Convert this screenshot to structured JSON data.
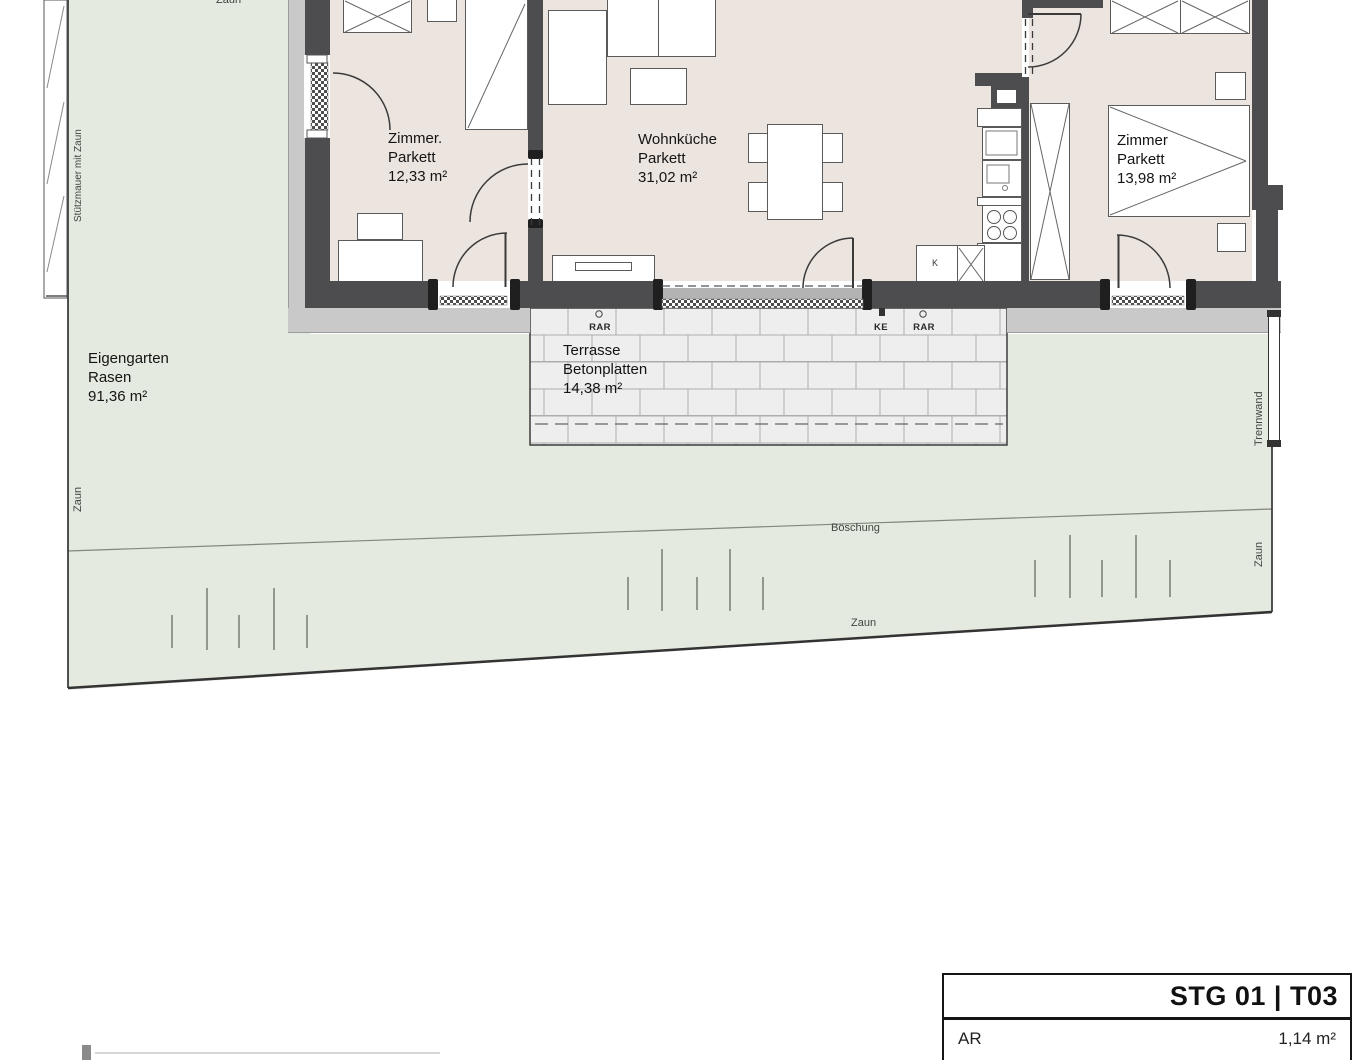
{
  "plan": {
    "rooms": {
      "zimmer_left": {
        "name": "Zimmer.",
        "floor": "Parkett",
        "area": "12,33 m²"
      },
      "wohnkueche": {
        "name": "Wohnküche",
        "floor": "Parkett",
        "area": "31,02 m²"
      },
      "zimmer_right": {
        "name": "Zimmer",
        "floor": "Parkett",
        "area": "13,98 m²"
      }
    },
    "outdoor": {
      "garden": {
        "name": "Eigengarten",
        "surface": "Rasen",
        "area": "91,36 m²"
      },
      "terrace": {
        "name": "Terrasse",
        "surface": "Betonplatten",
        "area": "14,38 m²"
      },
      "slope": "Böschung",
      "fence_top": "Zaun",
      "fence_left": "Zaun",
      "fence_bottom": "Zaun",
      "fence_right": "Zaun",
      "retaining_wall": "Stützmauer mit Zaun",
      "partition": "Trennwand"
    },
    "markers": {
      "rar_left": "RAR",
      "ke": "KE",
      "rar_right": "RAR",
      "kitchen_k": "K"
    }
  },
  "title_block": {
    "title": "STG 01 | T03",
    "rows": [
      {
        "label": "AR",
        "value": "1,14 m²"
      }
    ]
  },
  "colors": {
    "garden_green": "#e4eadf",
    "interior_beige": "#ece4df",
    "wall_gray": "#4d4d4f",
    "apron_gray": "#c9c9c9",
    "terrace_gray": "#eeeeee"
  }
}
